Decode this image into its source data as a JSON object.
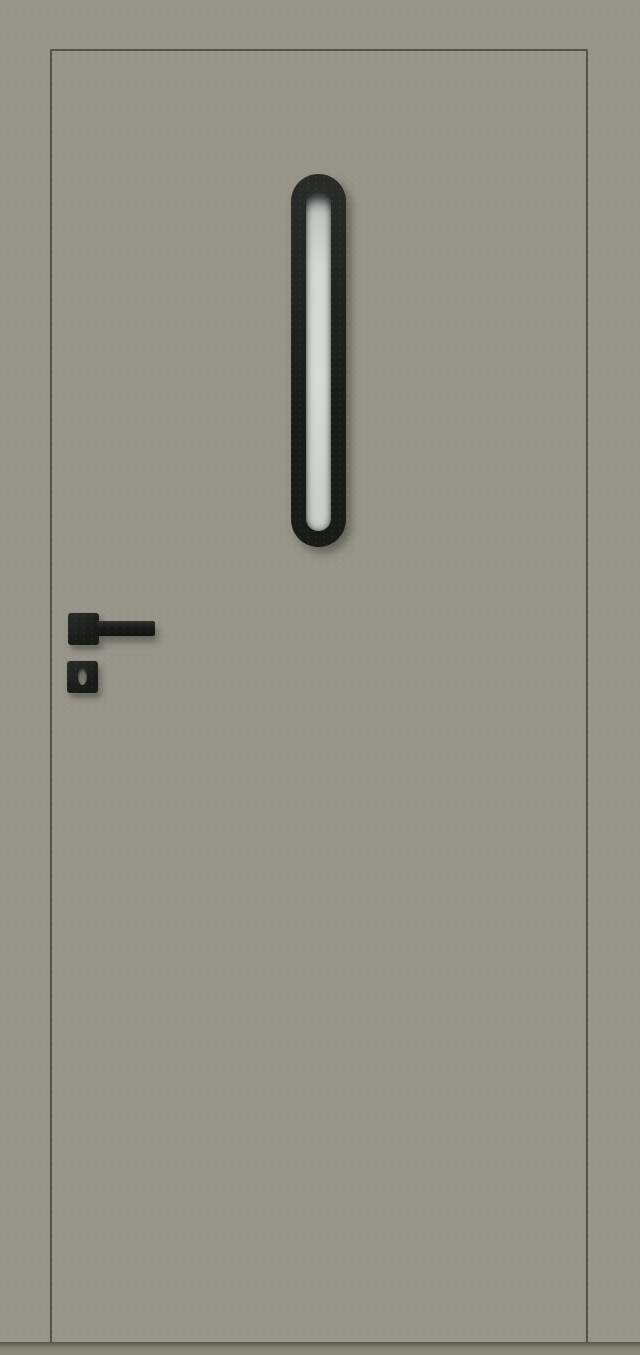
{
  "scene": {
    "type": "product-render",
    "subject": "exterior door, front view"
  },
  "parts": {
    "wall": "door-frame-surround",
    "door_leaf": "door-leaf",
    "glazing_frame": "glazing-frame",
    "glass_panel": "glass-panel",
    "handle_rosette": "handle-rosette",
    "handle_lever": "door-handle-lever",
    "keyhole_escutcheon": "keyhole-escutcheon",
    "keyhole": "keyhole",
    "floor_shadow": "floor-shadow"
  },
  "colors": {
    "wall": "#97958a",
    "door_outline": "#50524c",
    "hardware_dark": "#191b19",
    "hardware_light": "#2a2c2a",
    "glass_top": "#9aa09d",
    "glass_main": "#d3d8d4",
    "glass_bottom": "#c7ccc8",
    "keyhole": "#6f6f67",
    "floor_shadow": "#53554d",
    "floor": "#908e83"
  }
}
